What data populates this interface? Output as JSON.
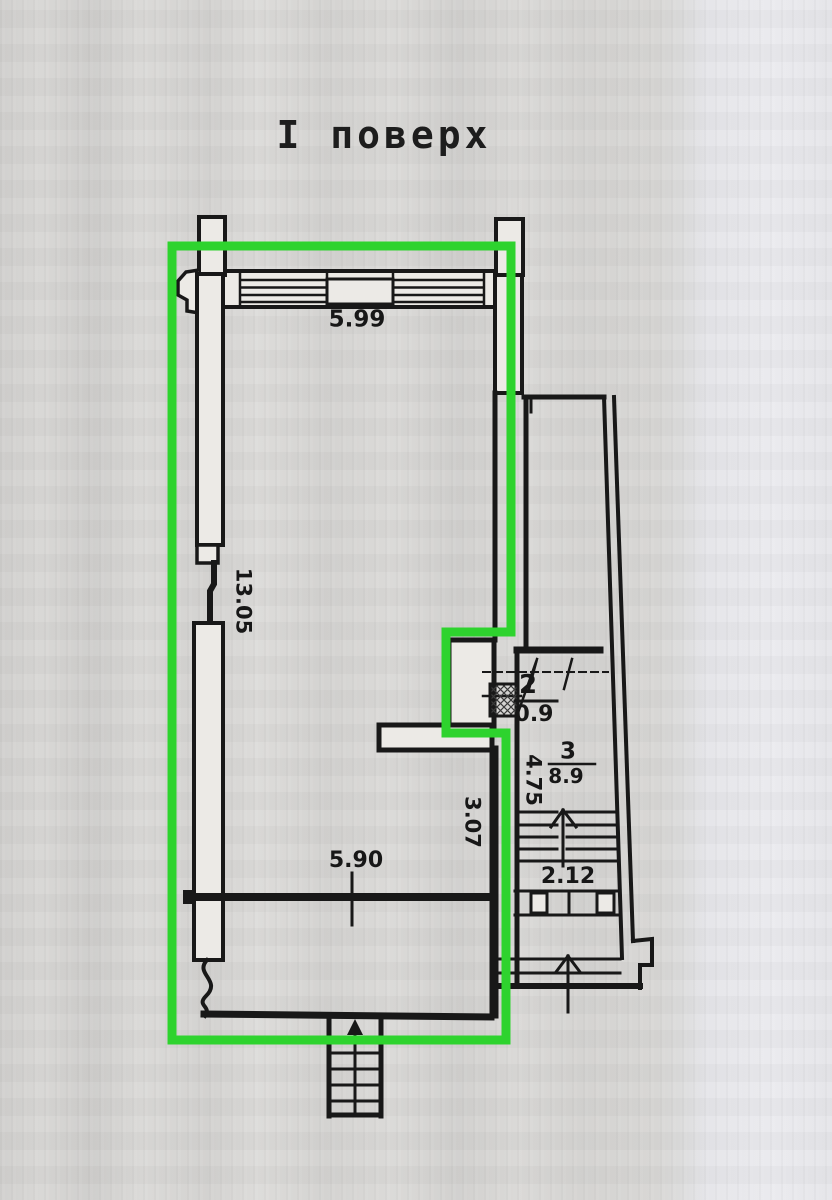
{
  "title": "І поверх",
  "colors": {
    "highlight": "#2ed32e",
    "ink": "#181818"
  },
  "plan": {
    "dimensions": {
      "top_wall_width": "5.99",
      "left_wall_height": "13.05",
      "hall_width": "5.90",
      "right_wall_height": "3.07",
      "stair_depth": "4.75",
      "stair_width": "2.12"
    },
    "rooms": [
      {
        "number": "2",
        "area": "0.9"
      },
      {
        "number": "3",
        "area": "8.9"
      }
    ]
  }
}
